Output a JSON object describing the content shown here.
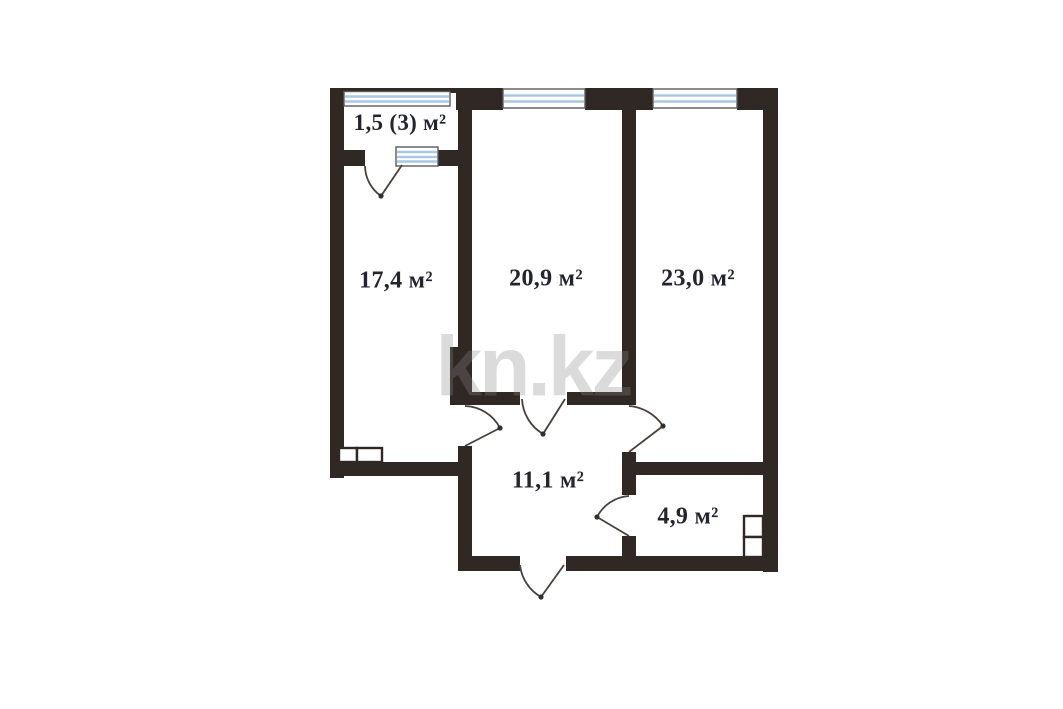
{
  "page": {
    "background_color": "#ffffff"
  },
  "floorplan": {
    "watermark": "kn.kz",
    "colors": {
      "wall": "#2f2824",
      "window": "#a9c8e3",
      "door_arc": "#46413c",
      "label": "#24242e",
      "watermark": "#8a8a8a"
    },
    "rooms": [
      {
        "id": "balcony",
        "label": "1,5 (3) м²"
      },
      {
        "id": "room-17-4",
        "label": "17,4 м²"
      },
      {
        "id": "room-20-9",
        "label": "20,9 м²"
      },
      {
        "id": "room-23-0",
        "label": "23,0 м²"
      },
      {
        "id": "hallway",
        "label": "11,1 м²"
      },
      {
        "id": "bathroom",
        "label": "4,9 м²"
      }
    ]
  }
}
